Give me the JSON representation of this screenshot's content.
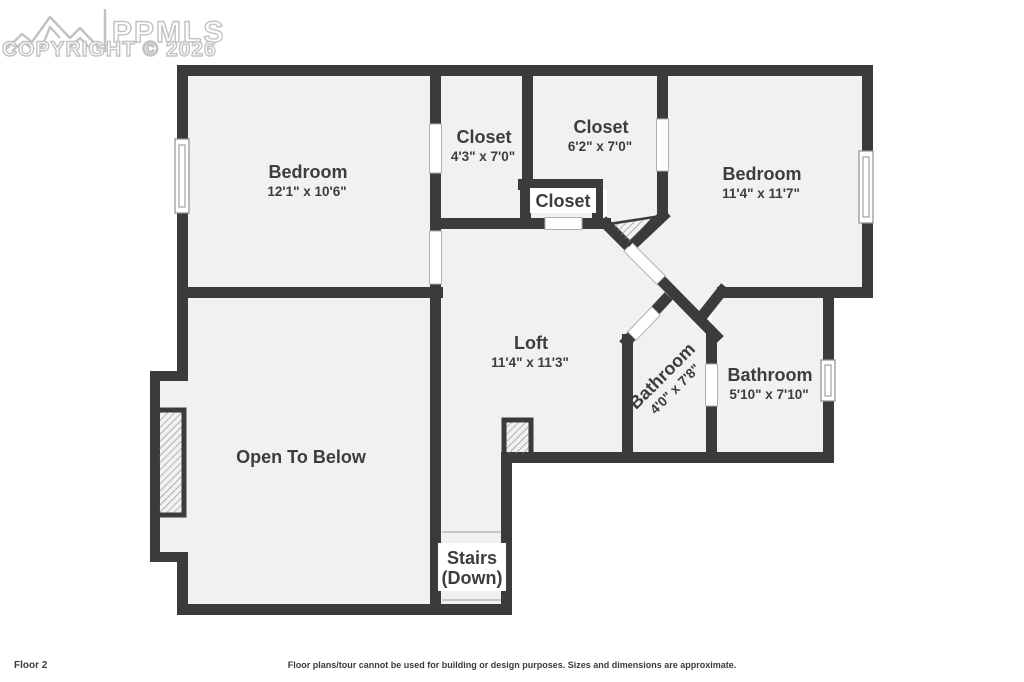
{
  "watermark": {
    "brand": "PPMLS",
    "copyright": "COPYRIGHT © 2026"
  },
  "rooms": {
    "bedroom1": {
      "name": "Bedroom",
      "dims": "12'1\" x 10'6\""
    },
    "closet1": {
      "name": "Closet",
      "dims": "4'3\" x 7'0\""
    },
    "closet2": {
      "name": "Closet",
      "dims": "6'2\" x 7'0\""
    },
    "hall_closet": {
      "name": "Closet"
    },
    "bedroom2": {
      "name": "Bedroom",
      "dims": "11'4\" x 11'7\""
    },
    "loft": {
      "name": "Loft",
      "dims": "11'4\" x 11'3\""
    },
    "bathroom1": {
      "name": "Bathroom",
      "dims": "4'0\" x 7'8\""
    },
    "bathroom2": {
      "name": "Bathroom",
      "dims": "5'10\" x 7'10\""
    },
    "open_to_below": {
      "name": "Open To Below"
    },
    "stairs": {
      "name": "Stairs",
      "direction": "(Down)"
    }
  },
  "footer": {
    "floor_label": "Floor 2",
    "disclaimer": "Floor plans/tour cannot be used for building or design purposes. Sizes and dimensions are approximate."
  },
  "colors": {
    "wall": "#3b3b3b",
    "floor": "#f1f1f1",
    "text": "#3d3d3d",
    "watermark": "#c2c2c2"
  }
}
